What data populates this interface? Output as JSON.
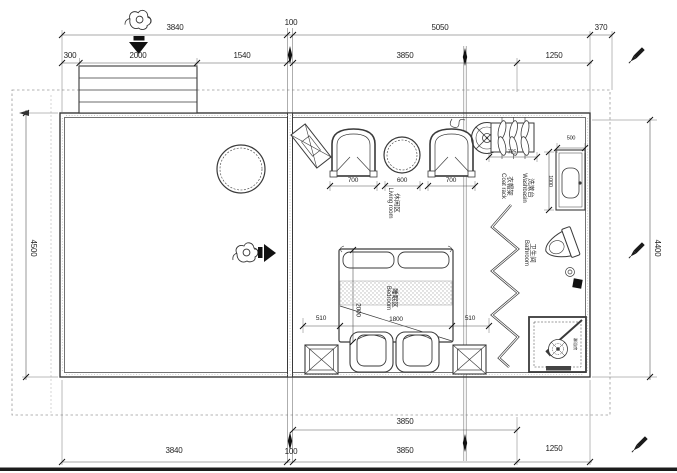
{
  "colors": {
    "line": "#3a3a3a",
    "light_line": "#999999",
    "text": "#1f1f1f",
    "marker": "#111111",
    "paper": "#ffffff"
  },
  "dims": {
    "top_row1": [
      "3840",
      "100",
      "5050",
      "370"
    ],
    "top_row2": [
      "300",
      "2000",
      "1540",
      "3850",
      "1250"
    ],
    "left_side": "4500",
    "right_side": "4400",
    "bottom_row1": [
      "3850"
    ],
    "bottom_row2": [
      "3840",
      "100",
      "3850",
      "1250"
    ]
  },
  "furniture": {
    "armchair_left_width": "700",
    "tea_table_width": "600",
    "armchair_right_width": "700",
    "coat_rack_width": "725",
    "washbasin_width": "500",
    "washbasin_depth": "1000",
    "bed_side_left": "510",
    "bed_width": "1800",
    "bed_side_right": "510",
    "bed_length": "2000"
  },
  "rooms": {
    "living": {
      "zh": "休闲区",
      "en": "Living room"
    },
    "bedroom": {
      "zh": "睡眠区",
      "en": "Bedroom"
    },
    "bathroom": {
      "zh": "卫生间",
      "en": "Bathroom"
    },
    "washbasin": {
      "zh": "洗漱台",
      "en": "Washbasin"
    },
    "coat_rack": {
      "zh": "衣帽架",
      "en": "Coat rack"
    },
    "shower": {
      "zh": "淋浴房",
      "en": ""
    }
  }
}
